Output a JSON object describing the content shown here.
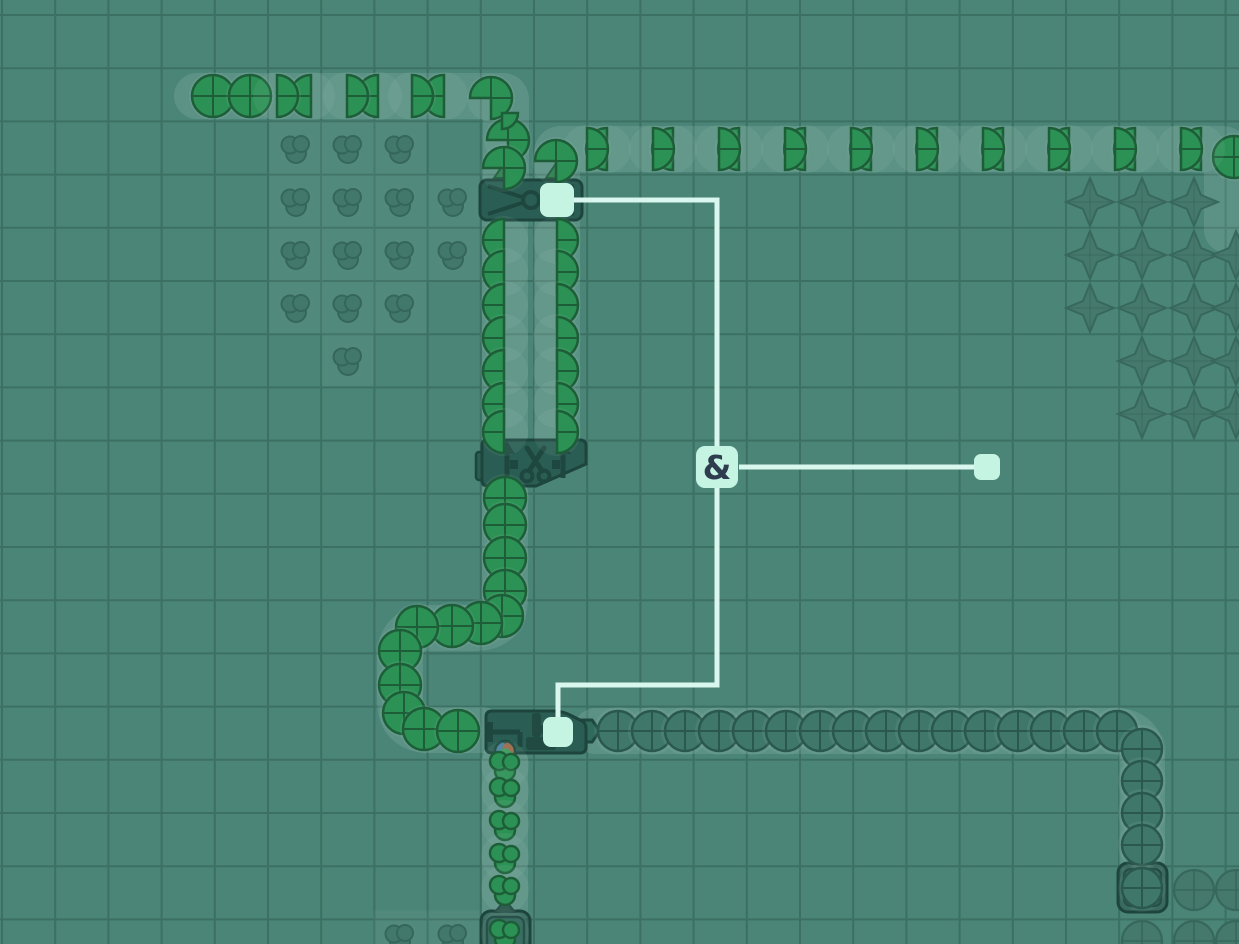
{
  "scene_title": "factory-game wires layer view",
  "colors": {
    "bg": "#4a8577",
    "grid": "#3c7063",
    "strip": "rgba(216,240,233,0.13)",
    "cell_glow": "rgba(224,244,238,0.05)",
    "pad": "rgba(218,240,233,0.07)",
    "building_fill": "#2a5e54",
    "building_stroke": "#1d453e",
    "building_icon": "#1e473f",
    "building_inner": "#2e665a",
    "miner_outer": "rgba(42,84,74,0.55)",
    "green": "#2c9154",
    "green_stroke": "#1d5e38",
    "dim_fill": "#3f786b",
    "dim_stroke": "#2b584e",
    "faded_fill": "#45796c",
    "faded_stroke": "#38685c",
    "faded_paint_fill": "#41756a",
    "faded_paint_stroke": "#336358",
    "triangle_fill": "#2e7c4e",
    "triangle_stroke": "#1e5c3a",
    "wire": "#d9f7ee",
    "node_fill": "#c5f4e3",
    "gate_text": "#2e3c4d",
    "paint_dot_blue": "#47819f",
    "paint_dot_red": "#9a6a4a",
    "paint_dot_green": "#3a9a5e"
  },
  "grid": {
    "cell": 53.2,
    "offset_x": 2,
    "offset_y": 15,
    "width": 1239,
    "height": 944
  },
  "scene": {
    "belts": [
      {
        "name": "belt-top-left-row",
        "path": "M197,96 L503,96 Q506,96 506,100 L506,176"
      },
      {
        "name": "belt-upper-row-right",
        "path": "M557,182 L557,153 Q557,149 561,149 L1222,149 Q1227,149 1227,154 L1227,230"
      },
      {
        "name": "belt-column-left-to-balancer",
        "path": "M505,222 L505,438"
      },
      {
        "name": "belt-column-right-to-balancer",
        "path": "M557,222 L557,438"
      },
      {
        "name": "belt-u-loop-to-painter",
        "path": "M505,492 L505,598 Q505,628 475,628 L430,628 Q400,628 400,658 L400,700 Q400,730 430,730 L482,730"
      },
      {
        "name": "belt-bottom-row-from-miner",
        "path": "M596,731 L1114,731 Q1142,731 1142,759 L1142,860"
      },
      {
        "name": "belt-paint-column",
        "path": "M505,761 L505,912"
      }
    ],
    "buildings": [
      {
        "type": "balancer",
        "name": "balancer-building",
        "x": 478,
        "y": 178
      },
      {
        "type": "cutter",
        "name": "cutter-building",
        "x": 478,
        "y": 436
      },
      {
        "type": "painter",
        "name": "painter-building",
        "x": 482,
        "y": 705
      },
      {
        "type": "miner",
        "name": "miner-circle-building",
        "x": 1116,
        "y": 861
      },
      {
        "type": "miner",
        "name": "miner-paint-building",
        "x": 479,
        "y": 909
      }
    ],
    "belt_input_triangles": [
      [
        505,
        170
      ],
      [
        557,
        170
      ]
    ],
    "items": {
      "full_green": [
        [
          213,
          96
        ],
        [
          250,
          96
        ],
        [
          505,
          498
        ],
        [
          505,
          525
        ],
        [
          505,
          558
        ],
        [
          505,
          591
        ],
        [
          502,
          616
        ],
        [
          481,
          623
        ],
        [
          452,
          626
        ],
        [
          417,
          627
        ],
        [
          400,
          651
        ],
        [
          400,
          685
        ],
        [
          404,
          713
        ],
        [
          424,
          729
        ],
        [
          458,
          731
        ],
        [
          1234,
          157
        ]
      ],
      "half_left": [
        [
          311,
          96
        ],
        [
          378,
          96
        ],
        [
          444,
          96
        ],
        [
          504,
          240
        ],
        [
          504,
          272
        ],
        [
          504,
          305
        ],
        [
          504,
          338
        ],
        [
          504,
          371
        ],
        [
          504,
          404
        ],
        [
          504,
          432
        ],
        [
          607,
          149
        ],
        [
          673,
          149
        ],
        [
          739,
          149
        ],
        [
          805,
          149
        ],
        [
          871,
          149
        ],
        [
          937,
          149
        ],
        [
          1003,
          149
        ],
        [
          1069,
          149
        ],
        [
          1135,
          149
        ],
        [
          1201,
          149
        ]
      ],
      "half_right": [
        [
          277,
          96
        ],
        [
          347,
          96
        ],
        [
          412,
          96
        ],
        [
          557,
          240
        ],
        [
          557,
          272
        ],
        [
          557,
          305
        ],
        [
          557,
          338
        ],
        [
          557,
          371
        ],
        [
          557,
          404
        ],
        [
          557,
          432
        ],
        [
          587,
          149
        ],
        [
          653,
          149
        ],
        [
          719,
          149
        ],
        [
          785,
          149
        ],
        [
          851,
          149
        ],
        [
          917,
          149
        ],
        [
          983,
          149
        ],
        [
          1049,
          149
        ],
        [
          1115,
          149
        ],
        [
          1181,
          149
        ]
      ],
      "pie34": [
        [
          491,
          98
        ],
        [
          508,
          140
        ],
        [
          504,
          168
        ],
        [
          556,
          161
        ]
      ],
      "quarter": [
        [
          502,
          113
        ]
      ],
      "dim_circle": [
        [
          618,
          731
        ],
        [
          652,
          731
        ],
        [
          685,
          731
        ],
        [
          719,
          731
        ],
        [
          753,
          731
        ],
        [
          786,
          731
        ],
        [
          820,
          731
        ],
        [
          853,
          731
        ],
        [
          886,
          731
        ],
        [
          919,
          731
        ],
        [
          952,
          731
        ],
        [
          985,
          731
        ],
        [
          1018,
          731
        ],
        [
          1051,
          731
        ],
        [
          1084,
          731
        ],
        [
          1117,
          731
        ],
        [
          1142,
          749
        ],
        [
          1142,
          781
        ],
        [
          1142,
          813
        ],
        [
          1142,
          845
        ],
        [
          1142,
          888
        ]
      ],
      "paint_blob": [
        [
          505,
          765
        ],
        [
          505,
          791
        ],
        [
          505,
          824
        ],
        [
          505,
          857
        ],
        [
          505,
          889
        ],
        [
          505,
          933
        ]
      ]
    },
    "faded_resources": {
      "paint": [
        [
          296,
          148
        ],
        [
          348,
          148
        ],
        [
          400,
          148
        ],
        [
          296,
          201
        ],
        [
          348,
          201
        ],
        [
          400,
          201
        ],
        [
          453,
          201
        ],
        [
          296,
          254
        ],
        [
          348,
          254
        ],
        [
          400,
          254
        ],
        [
          453,
          254
        ],
        [
          296,
          307
        ],
        [
          348,
          307
        ],
        [
          400,
          307
        ],
        [
          348,
          360
        ],
        [
          400,
          937
        ],
        [
          453,
          937
        ]
      ],
      "star": [
        [
          1090,
          202
        ],
        [
          1142,
          202
        ],
        [
          1194,
          202
        ],
        [
          1090,
          255
        ],
        [
          1142,
          255
        ],
        [
          1194,
          255
        ],
        [
          1236,
          255
        ],
        [
          1090,
          308
        ],
        [
          1142,
          308
        ],
        [
          1194,
          308
        ],
        [
          1236,
          308
        ],
        [
          1142,
          361
        ],
        [
          1194,
          361
        ],
        [
          1236,
          361
        ],
        [
          1142,
          414
        ],
        [
          1194,
          414
        ],
        [
          1236,
          414
        ]
      ],
      "circle": [
        [
          1194,
          890
        ],
        [
          1236,
          890
        ],
        [
          1142,
          941
        ],
        [
          1194,
          941
        ],
        [
          1236,
          941
        ]
      ]
    },
    "wires": {
      "segments": [
        "M557,200 H717 V685 H558 V718",
        "M739,467 H975"
      ],
      "nodes": [
        {
          "name": "wire-node-balancer",
          "x": 540,
          "y": 183,
          "s": 34,
          "r": 8
        },
        {
          "name": "wire-node-painter",
          "x": 543,
          "y": 717,
          "s": 30,
          "r": 8
        },
        {
          "name": "wire-node-free",
          "x": 974,
          "y": 454,
          "s": 26,
          "r": 7
        }
      ],
      "gate": {
        "name": "and-gate",
        "x": 696,
        "y": 446,
        "s": 42,
        "r": 9,
        "label": "&"
      }
    }
  }
}
